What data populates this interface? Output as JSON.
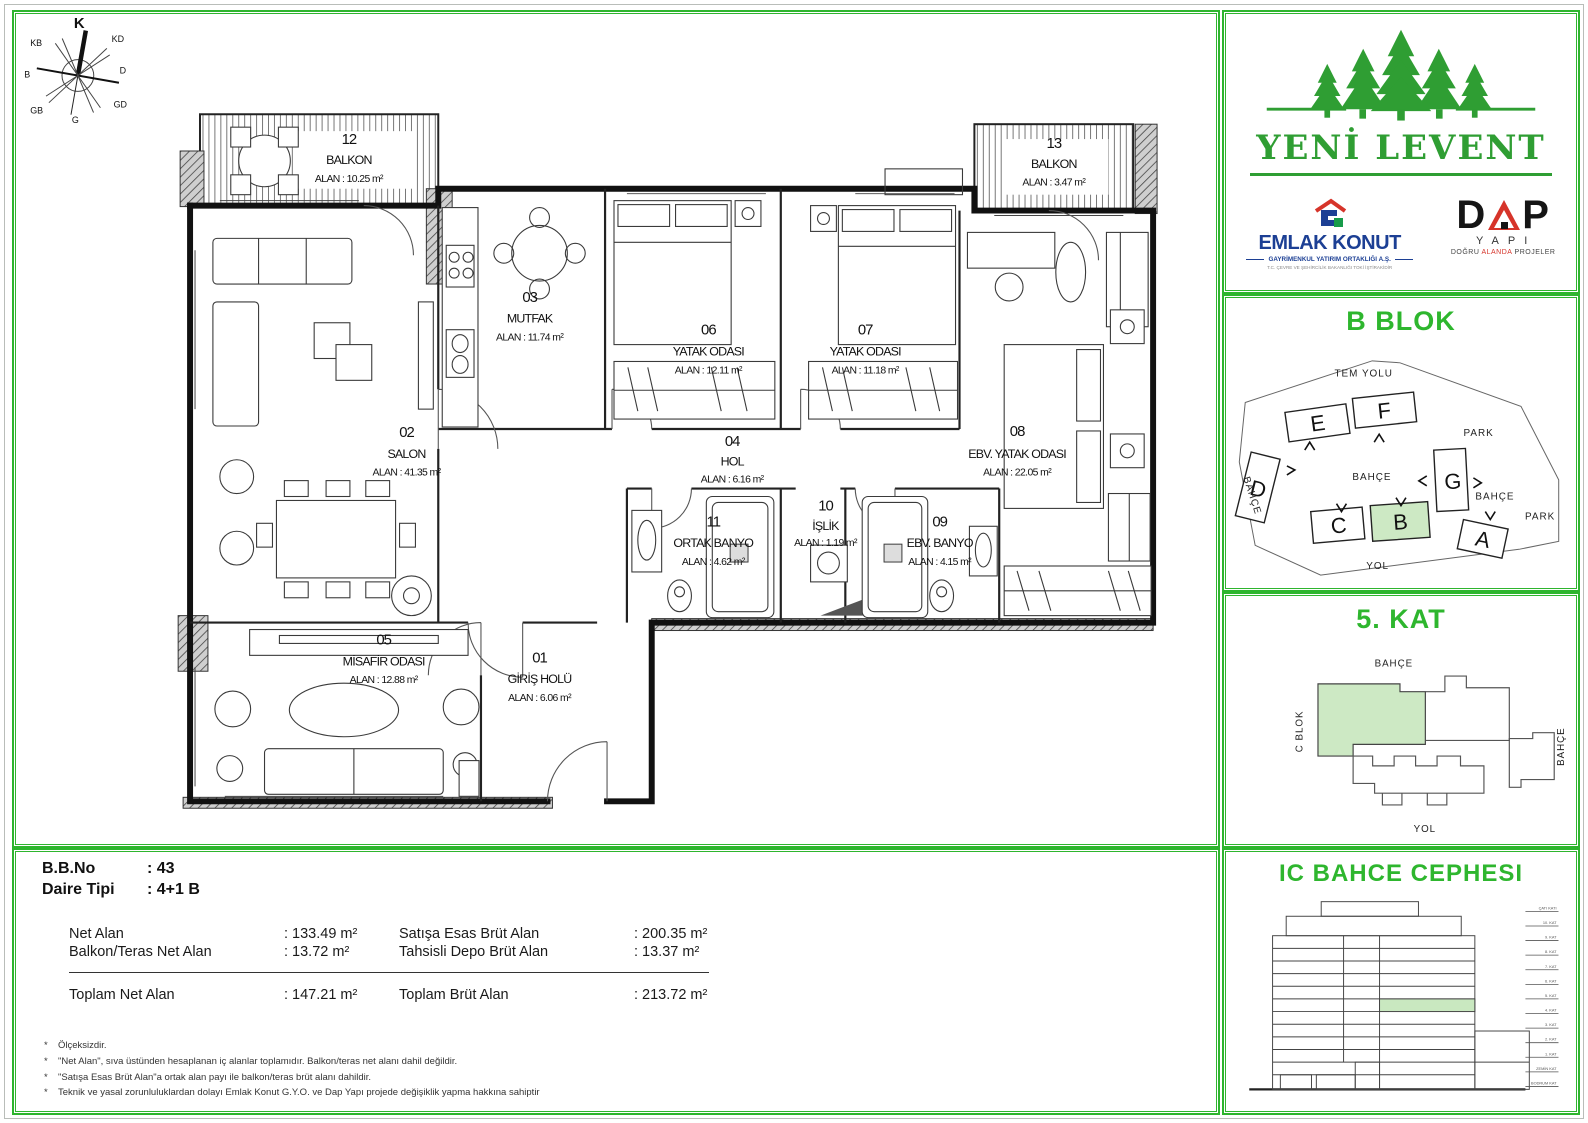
{
  "colors": {
    "frame_green": "#2eb52e",
    "logo_green": "#2f9e33",
    "highlight_green": "#cde9c4",
    "emlak_blue": "#1c3f94",
    "dap_red": "#d6342a"
  },
  "compass": {
    "labels": [
      "K",
      "KD",
      "D",
      "GD",
      "G",
      "GB",
      "B",
      "KB"
    ]
  },
  "plan": {
    "rooms": [
      {
        "number": "01",
        "name": "GİRİŞ HOLÜ",
        "area": "ALAN : 6.06 m²"
      },
      {
        "number": "02",
        "name": "SALON",
        "area": "ALAN : 41.35 m²"
      },
      {
        "number": "03",
        "name": "MUTFAK",
        "area": "ALAN : 11.74 m²"
      },
      {
        "number": "04",
        "name": "HOL",
        "area": "ALAN : 6.16 m²"
      },
      {
        "number": "05",
        "name": "MİSAFİR ODASI",
        "area": "ALAN : 12.88 m²"
      },
      {
        "number": "06",
        "name": "YATAK ODASI",
        "area": "ALAN : 12.11 m²"
      },
      {
        "number": "07",
        "name": "YATAK ODASI",
        "area": "ALAN : 11.18 m²"
      },
      {
        "number": "08",
        "name": "EBV. YATAK ODASI",
        "area": "ALAN : 22.05 m²"
      },
      {
        "number": "09",
        "name": "EBV. BANYO",
        "area": "ALAN : 4.15 m²"
      },
      {
        "number": "10",
        "name": "İŞLİK",
        "area": "ALAN : 1.19 m²"
      },
      {
        "number": "11",
        "name": "ORTAK BANYO",
        "area": "ALAN : 4.62 m²"
      },
      {
        "number": "12",
        "name": "BALKON",
        "area": "ALAN : 10.25 m²"
      },
      {
        "number": "13",
        "name": "BALKON",
        "area": "ALAN : 3.47 m²"
      }
    ]
  },
  "branding": {
    "project_name": "YENİ LEVENT",
    "emlak_konut": {
      "name": "EMLAK KONUT",
      "sub": "GAYRİMENKUL YATIRIM ORTAKLIĞI A.Ş.",
      "tagline": "T.C. ÇEVRE VE ŞEHİRCİLİK BAKANLIĞI TOKİ İŞTİRAKİDİR"
    },
    "dap": {
      "d": "D",
      "p": "P",
      "sub": "YAPI",
      "tag1": "DOĞRU",
      "tag2": "ALANDA",
      "tag3": "PROJELER"
    }
  },
  "site": {
    "title": "B BLOK",
    "highlighted_block": "B",
    "blocks": [
      "E",
      "F",
      "D",
      "G",
      "C",
      "B",
      "A"
    ],
    "labels": {
      "tem_yolu": "TEM YOLU",
      "park_top": "PARK",
      "bahce_left": "BAHÇE",
      "bahce_center": "BAHÇE",
      "bahce_right": "BAHÇE",
      "park_right": "PARK",
      "yol": "YOL"
    }
  },
  "floor5": {
    "title": "5. KAT",
    "labels": {
      "bahce_top": "BAHÇE",
      "c_blok": "C BLOK",
      "bahce_right": "BAHÇE",
      "yol": "YOL"
    }
  },
  "elevation": {
    "title": "IC BAHCE CEPHESI",
    "floors": [
      "ÇATI KATI",
      "10. KAT",
      "9. KAT",
      "8. KAT",
      "7. KAT",
      "6. KAT",
      "5. KAT",
      "4. KAT",
      "3. KAT",
      "2. KAT",
      "1. KAT",
      "ZEMİN KAT",
      "BODRUM KAT"
    ]
  },
  "info": {
    "bb_no": {
      "label": "B.B.No",
      "value": ": 43"
    },
    "daire_tipi": {
      "label": "Daire Tipi",
      "value": ": 4+1 B"
    },
    "net_alan": {
      "label": "Net Alan",
      "value": ": 133.49 m²"
    },
    "balkon_teras": {
      "label": "Balkon/Teras Net Alan",
      "value": ": 13.72 m²"
    },
    "satisa_esas": {
      "label": "Satışa Esas Brüt Alan",
      "value": ": 200.35 m²"
    },
    "tahsisli_depo": {
      "label": "Tahsisli Depo Brüt Alan",
      "value": ": 13.37 m²"
    },
    "toplam_net": {
      "label": "Toplam Net Alan",
      "value": ": 147.21 m²"
    },
    "toplam_brut": {
      "label": "Toplam Brüt Alan",
      "value": ": 213.72 m²"
    },
    "footnotes": [
      "Ölçeksizdir.",
      "\"Net Alan\", sıva üstünden hesaplanan iç alanlar toplamıdır. Balkon/teras net alanı dahil değildir.",
      "\"Satışa Esas Brüt Alan\"a ortak alan payı ile balkon/teras brüt alanı dahildir.",
      "Teknik ve yasal zorunluluklardan dolayı Emlak Konut G.Y.O. ve Dap Yapı projede değişiklik yapma hakkına sahiptir"
    ]
  }
}
